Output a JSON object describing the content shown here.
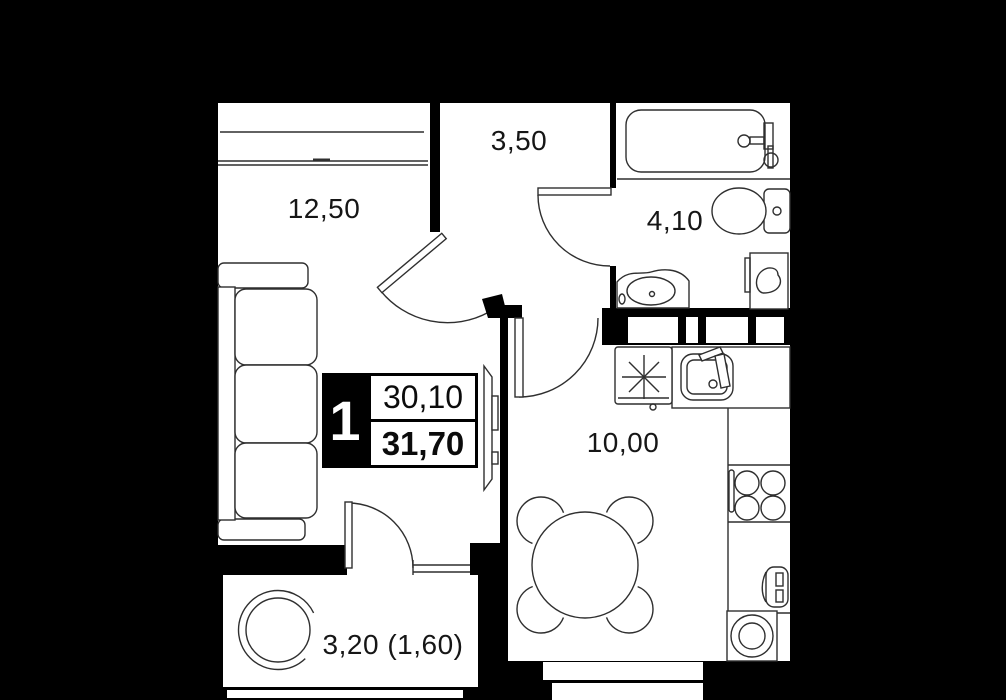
{
  "plan": {
    "flag": {
      "rooms_count": "1",
      "area_living": "30,10",
      "area_total": "31,70"
    },
    "rooms": [
      {
        "id": "living-room",
        "area_label": "12,50"
      },
      {
        "id": "hallway",
        "area_label": "3,50"
      },
      {
        "id": "bathroom",
        "area_label": "4,10"
      },
      {
        "id": "kitchen",
        "area_label": "10,00"
      },
      {
        "id": "balcony",
        "area_label": "3,20 (1,60)"
      }
    ],
    "colors": {
      "background": "#000000",
      "floor": "#ffffff",
      "stroke": "#2f2f2f",
      "flag_bg": "#000000",
      "flag_text": "#ffffff"
    },
    "fixtures": [
      "sofa",
      "tv",
      "window",
      "door-swing",
      "bathtub",
      "toilet",
      "sink",
      "water-heater",
      "refrigerator-snowflake",
      "kitchen-sink",
      "stove-burners",
      "oven",
      "washing-machine",
      "dining-table",
      "dining-chair",
      "armchair"
    ]
  }
}
